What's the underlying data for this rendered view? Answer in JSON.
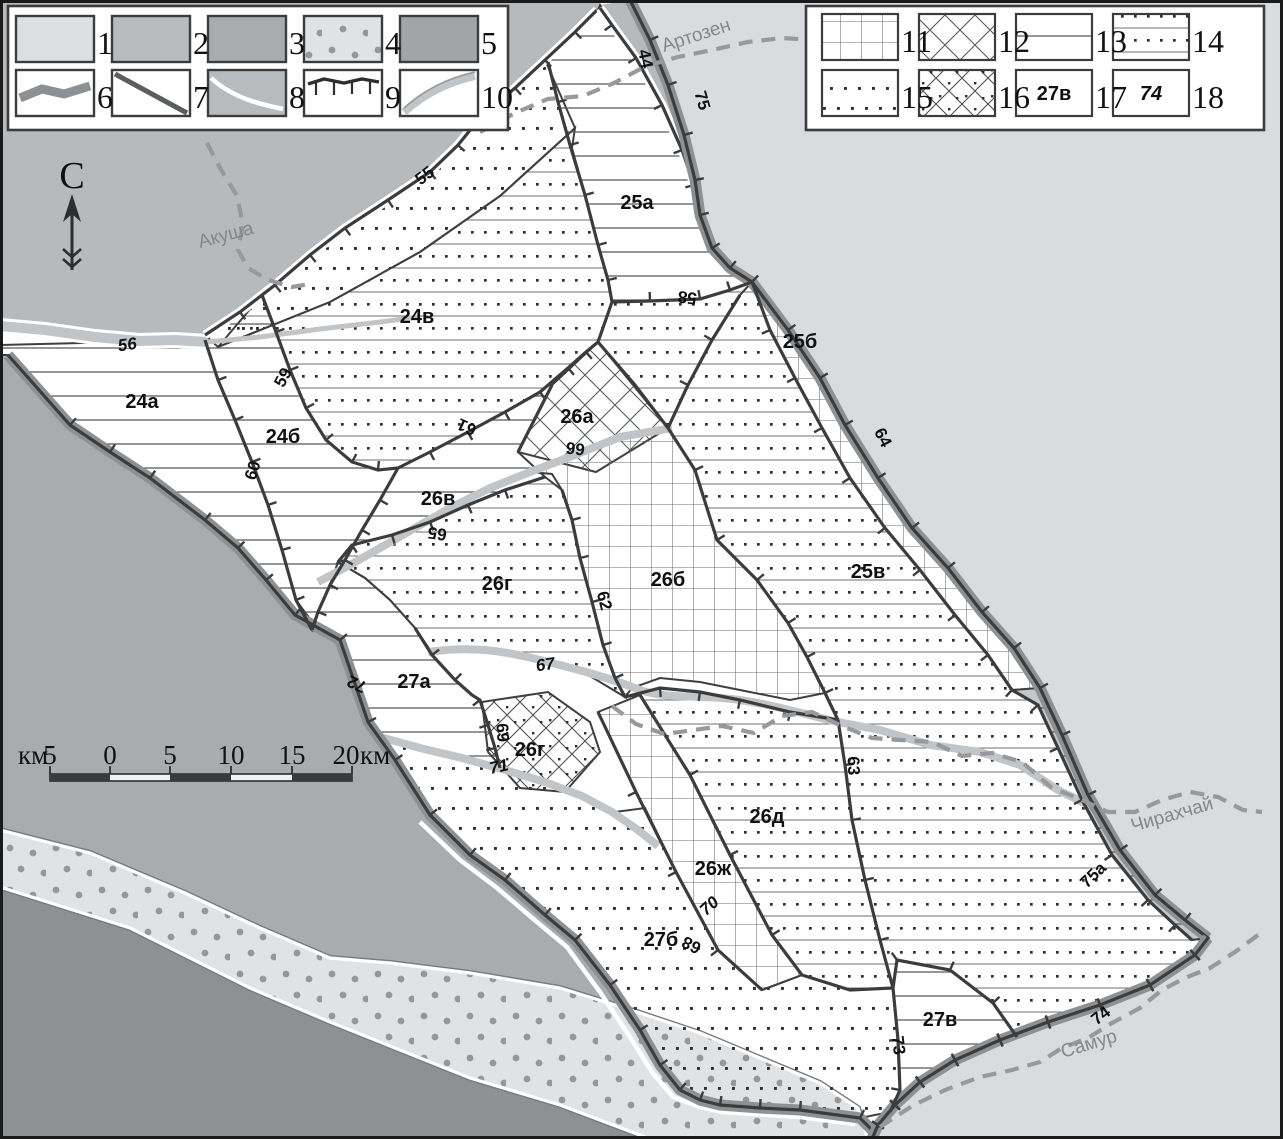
{
  "title": "Tectonic zoning sketch map",
  "colors": {
    "outside_east": "#d9dbde",
    "outside_northwest": "#b7babc",
    "outside_southwest": "#a9acae",
    "outside_dark": "#8e9194",
    "dotted_band_fill": "#e0e2e4",
    "dotted_band_dot": "#95989b",
    "boundary_band": "#8e9194",
    "fault_line": "#3c3c3c",
    "river_dash": "#97999c",
    "river_band": "#c2c5c7",
    "study_area": "#ffffff"
  },
  "legend_left": {
    "items": [
      {
        "n": "1",
        "type": "light-gray-area"
      },
      {
        "n": "2",
        "type": "medium-gray-area"
      },
      {
        "n": "3",
        "type": "gray-area"
      },
      {
        "n": "4",
        "type": "dotted-light-band-area"
      },
      {
        "n": "5",
        "type": "dark-gray-area"
      },
      {
        "n": "6",
        "type": "wide-gray-boundary-line"
      },
      {
        "n": "7",
        "type": "straight-gray-line"
      },
      {
        "n": "8",
        "type": "white-river-on-gray"
      },
      {
        "n": "9",
        "type": "hachured-fault-line"
      },
      {
        "n": "10",
        "type": "narrow-gray-river-band"
      }
    ]
  },
  "legend_right": {
    "items": [
      {
        "n": "11",
        "type": "grid-pattern"
      },
      {
        "n": "12",
        "type": "diagonal-crosshatch-pattern"
      },
      {
        "n": "13",
        "type": "horizontal-lines-pattern"
      },
      {
        "n": "14",
        "type": "lines-with-dots-pattern"
      },
      {
        "n": "15",
        "type": "dots-pattern"
      },
      {
        "n": "16",
        "type": "crosshatch-with-dots-pattern"
      },
      {
        "n": "17",
        "type": "zone-label-sample",
        "swatch_text": "27в"
      },
      {
        "n": "18",
        "type": "boundary-number-sample",
        "swatch_text": "74"
      }
    ]
  },
  "compass": {
    "label": "С"
  },
  "scalebar": {
    "unit_left": "км",
    "labels": [
      "5",
      "0",
      "5",
      "10",
      "15",
      "20"
    ],
    "unit_right": "км"
  },
  "map": {
    "region_labels": [
      "24а",
      "24б",
      "24в",
      "25а",
      "25б",
      "25в",
      "26а",
      "26б",
      "26в",
      "26г",
      "26г",
      "26д",
      "26ж",
      "27а",
      "27б",
      "27в"
    ],
    "fault_numbers": [
      "44",
      "55",
      "56",
      "58",
      "59",
      "60",
      "61",
      "62",
      "63",
      "64",
      "65",
      "66",
      "67",
      "68",
      "69",
      "70",
      "71",
      "72",
      "73",
      "74",
      "75",
      "75а"
    ],
    "rivers": [
      "Акуша",
      "Артозен",
      "Чирахчай",
      "Самур"
    ]
  }
}
